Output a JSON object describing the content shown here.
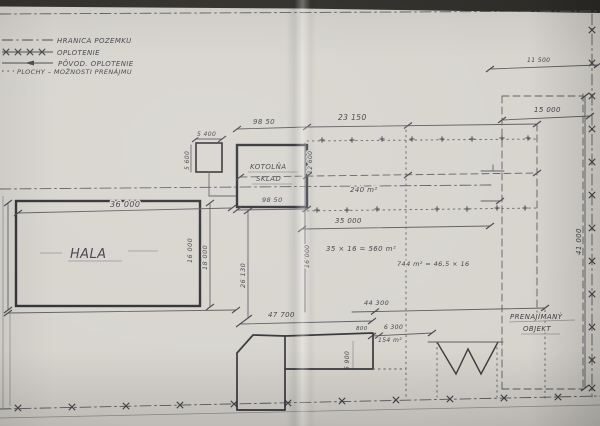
{
  "legend": {
    "items": [
      {
        "id": "boundary",
        "label": "HRANICA POZEMKU"
      },
      {
        "id": "fence",
        "label": "OPLOTENIE"
      },
      {
        "id": "orig-fence",
        "label": "PÔVOD. OPLOTENIE"
      },
      {
        "id": "areas",
        "label": "PLOCHY – MOŽNOSTI PRENÁJMU"
      }
    ]
  },
  "labels": {
    "hala": "HALA",
    "kotolna_line1": "KOTOLŇA",
    "kotolna_line2": "SKLAD",
    "rented_line1": "PRENAJÍMANÝ",
    "rented_line2": "OBJEKT"
  },
  "dimensions": {
    "hala_width": "36 000",
    "hala_depth_inner": "16 000",
    "hala_depth_outer": "18 000",
    "yard_depth": "26 130",
    "annex_width": "5 400",
    "annex_depth": "5 600",
    "kotolna_width_top": "98 50",
    "kotolna_width_bottom": "98 50",
    "kotolna_depth": "12 600",
    "site_width": "23 150",
    "rental_width": "35 000",
    "rental_depth": "16 000",
    "south_left": "47 700",
    "south_right": "44 300",
    "gate_small": "800",
    "gate_wide": "6 300",
    "ramp_depth": "5 900",
    "right_outer": "11 500",
    "rented_width": "15 000",
    "rented_depth": "41 000"
  },
  "areas": {
    "north_strip": "240 m²",
    "mid_block": "35 × 16 = 560 m²",
    "east_block": "744 m² = 46,5 × 16",
    "south_block": "154 m²"
  }
}
